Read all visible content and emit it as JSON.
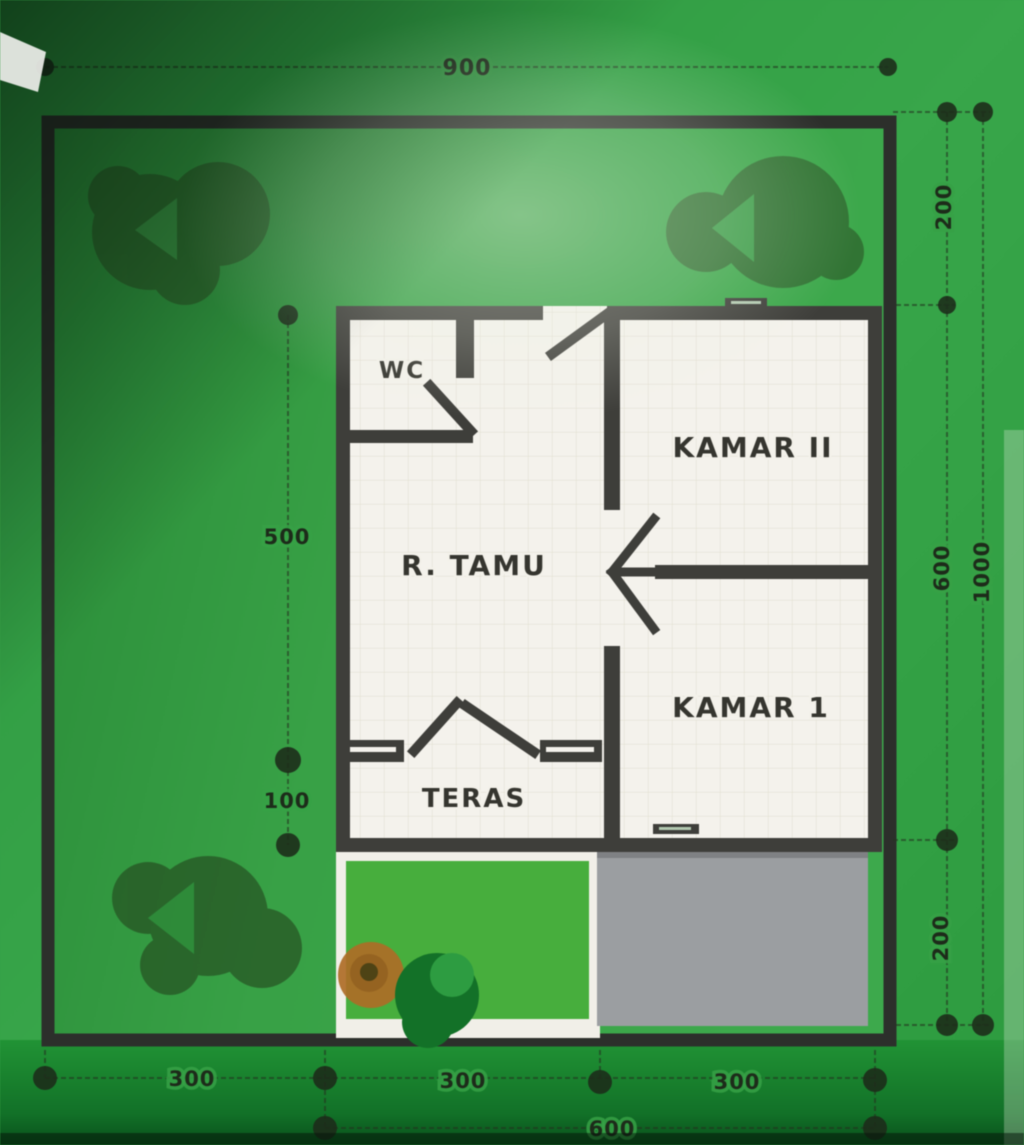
{
  "plan": {
    "rooms": {
      "wc": {
        "label": "WC"
      },
      "kamar2": {
        "label": "KAMAR II"
      },
      "rtamu": {
        "label": "R. TAMU"
      },
      "kamar1": {
        "label": "KAMAR 1"
      },
      "teras": {
        "label": "TERAS"
      }
    },
    "dimensions": {
      "top_width": "900",
      "right_top": "200",
      "right_middle": "600",
      "right_bottom": "200",
      "right_total": "1000",
      "left_main": "500",
      "left_teras": "100",
      "bottom_left": "300",
      "bottom_center": "300",
      "bottom_right": "300",
      "bottom_house": "600"
    },
    "colors": {
      "wall": "#3e3e3a",
      "label": "#35352f",
      "dimension": "#1d2b1a",
      "dimension_line": "#243420",
      "paper_green": "#3aa24b",
      "lawn_green": "#49ad3f",
      "carport_gray": "#9b9ea1",
      "floor_white": "#f4f2ec",
      "flower_orange": "#ad6d28",
      "shrub_green": "#157029",
      "tree_green": "#2a4a22"
    }
  }
}
